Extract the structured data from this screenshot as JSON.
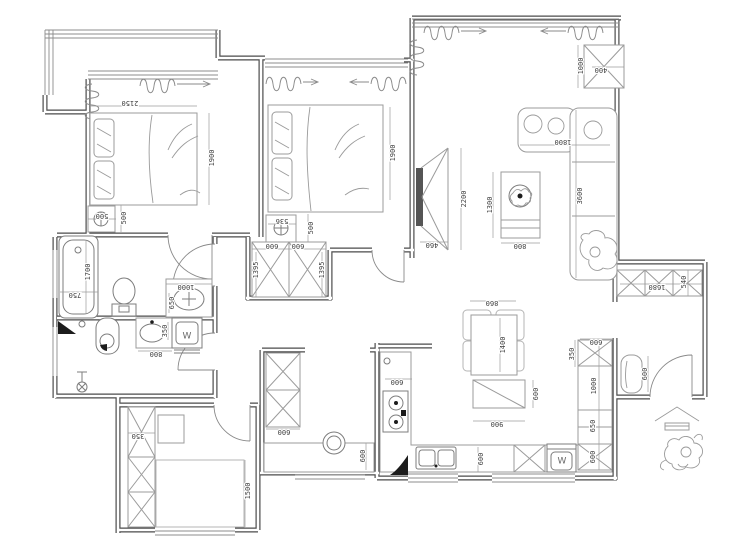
{
  "drawing": {
    "kind": "apartment-floor-plan"
  },
  "colors": {
    "background": "#ffffff",
    "wall": "#4b4b4b",
    "furniture": "#9b9b9b",
    "fixture": "#7d7d7d",
    "dimension_text": "#3c3c3c",
    "marker_black": "#1c1c1c"
  },
  "dimension_labels": [
    {
      "id": "bed1-width",
      "text": "2150",
      "x": 130,
      "y": 103,
      "rot": 180
    },
    {
      "id": "bed1-length",
      "text": "1900",
      "x": 212,
      "y": 158,
      "rot": -90
    },
    {
      "id": "bed1-nightstand-width",
      "text": "500",
      "x": 102,
      "y": 216,
      "rot": 180
    },
    {
      "id": "bed1-nightstand-depth",
      "text": "500",
      "x": 124,
      "y": 218,
      "rot": -90
    },
    {
      "id": "bed2-length",
      "text": "1900",
      "x": 393,
      "y": 153,
      "rot": -90
    },
    {
      "id": "bed2-nightstand-width",
      "text": "536",
      "x": 282,
      "y": 221,
      "rot": 180
    },
    {
      "id": "bed2-nightstand-depth",
      "text": "500",
      "x": 311,
      "y": 228,
      "rot": -90
    },
    {
      "id": "wardrobe-door-left",
      "text": "600",
      "x": 272,
      "y": 246,
      "rot": 180
    },
    {
      "id": "wardrobe-door-right",
      "text": "600",
      "x": 298,
      "y": 246,
      "rot": 180
    },
    {
      "id": "wardrobe-depth-left",
      "text": "1395",
      "x": 256,
      "y": 270,
      "rot": -90
    },
    {
      "id": "wardrobe-depth-right",
      "text": "1395",
      "x": 322,
      "y": 270,
      "rot": -90
    },
    {
      "id": "tv-wall-length",
      "text": "2200",
      "x": 464,
      "y": 199,
      "rot": -90
    },
    {
      "id": "tv-unit-depth",
      "text": "460",
      "x": 432,
      "y": 245,
      "rot": 180
    },
    {
      "id": "living-cabinet-length",
      "text": "1000",
      "x": 581,
      "y": 66,
      "rot": -90
    },
    {
      "id": "living-cabinet-depth",
      "text": "400",
      "x": 601,
      "y": 70,
      "rot": 180
    },
    {
      "id": "sofa-chaise-width",
      "text": "1800",
      "x": 563,
      "y": 142,
      "rot": 180
    },
    {
      "id": "sofa-length",
      "text": "3600",
      "x": 580,
      "y": 196,
      "rot": -90
    },
    {
      "id": "coffee-table-length",
      "text": "1300",
      "x": 490,
      "y": 205,
      "rot": -90
    },
    {
      "id": "coffee-table-width",
      "text": "800",
      "x": 520,
      "y": 246,
      "rot": 180
    },
    {
      "id": "dining-table-width",
      "text": "860",
      "x": 492,
      "y": 303,
      "rot": 180
    },
    {
      "id": "dining-table-length",
      "text": "1400",
      "x": 503,
      "y": 345,
      "rot": -90
    },
    {
      "id": "sideboard-width",
      "text": "900",
      "x": 497,
      "y": 424,
      "rot": 180
    },
    {
      "id": "sideboard-depth",
      "text": "600",
      "x": 536,
      "y": 394,
      "rot": -90
    },
    {
      "id": "stove-counter-width",
      "text": "600",
      "x": 397,
      "y": 382,
      "rot": 180
    },
    {
      "id": "pantry-cabinet-width",
      "text": "600",
      "x": 284,
      "y": 432,
      "rot": 180
    },
    {
      "id": "pantry-counter-depth",
      "text": "600",
      "x": 363,
      "y": 456,
      "rot": -90
    },
    {
      "id": "sink-counter-depth",
      "text": "600",
      "x": 481,
      "y": 459,
      "rot": -90
    },
    {
      "id": "column-top-width",
      "text": "600",
      "x": 596,
      "y": 342,
      "rot": 180
    },
    {
      "id": "column-seg-350",
      "text": "350",
      "x": 572,
      "y": 354,
      "rot": -90
    },
    {
      "id": "column-seg-1000",
      "text": "1000",
      "x": 594,
      "y": 386,
      "rot": -90
    },
    {
      "id": "column-seg-650",
      "text": "650",
      "x": 593,
      "y": 426,
      "rot": -90
    },
    {
      "id": "column-seg-600",
      "text": "600",
      "x": 593,
      "y": 457,
      "rot": -90
    },
    {
      "id": "entry-bench-length",
      "text": "600",
      "x": 645,
      "y": 374,
      "rot": -90
    },
    {
      "id": "shoe-cabinet-width",
      "text": "1680",
      "x": 657,
      "y": 287,
      "rot": 180
    },
    {
      "id": "shoe-cabinet-depth",
      "text": "540",
      "x": 684,
      "y": 282,
      "rot": -90
    },
    {
      "id": "bathtub-length",
      "text": "1700",
      "x": 88,
      "y": 272,
      "rot": -90
    },
    {
      "id": "bathtub-width",
      "text": "750",
      "x": 75,
      "y": 295,
      "rot": 180
    },
    {
      "id": "basin1-counter-width",
      "text": "1000",
      "x": 186,
      "y": 287,
      "rot": 180
    },
    {
      "id": "basin1-counter-depth",
      "text": "650",
      "x": 172,
      "y": 303,
      "rot": -90
    },
    {
      "id": "basin2-counter-width",
      "text": "800",
      "x": 156,
      "y": 354,
      "rot": 180
    },
    {
      "id": "basin2-counter-depth",
      "text": "350",
      "x": 165,
      "y": 331,
      "rot": -90
    },
    {
      "id": "study-cabinet-depth",
      "text": "350",
      "x": 138,
      "y": 436,
      "rot": 180
    },
    {
      "id": "study-bed-width",
      "text": "1500",
      "x": 248,
      "y": 491,
      "rot": -90
    }
  ],
  "appliance_labels": [
    {
      "id": "washer-bathroom",
      "text": "W",
      "x": 187,
      "y": 336,
      "rot": 0
    },
    {
      "id": "washer-kitchen",
      "text": "W",
      "x": 562,
      "y": 461,
      "rot": 0
    }
  ]
}
